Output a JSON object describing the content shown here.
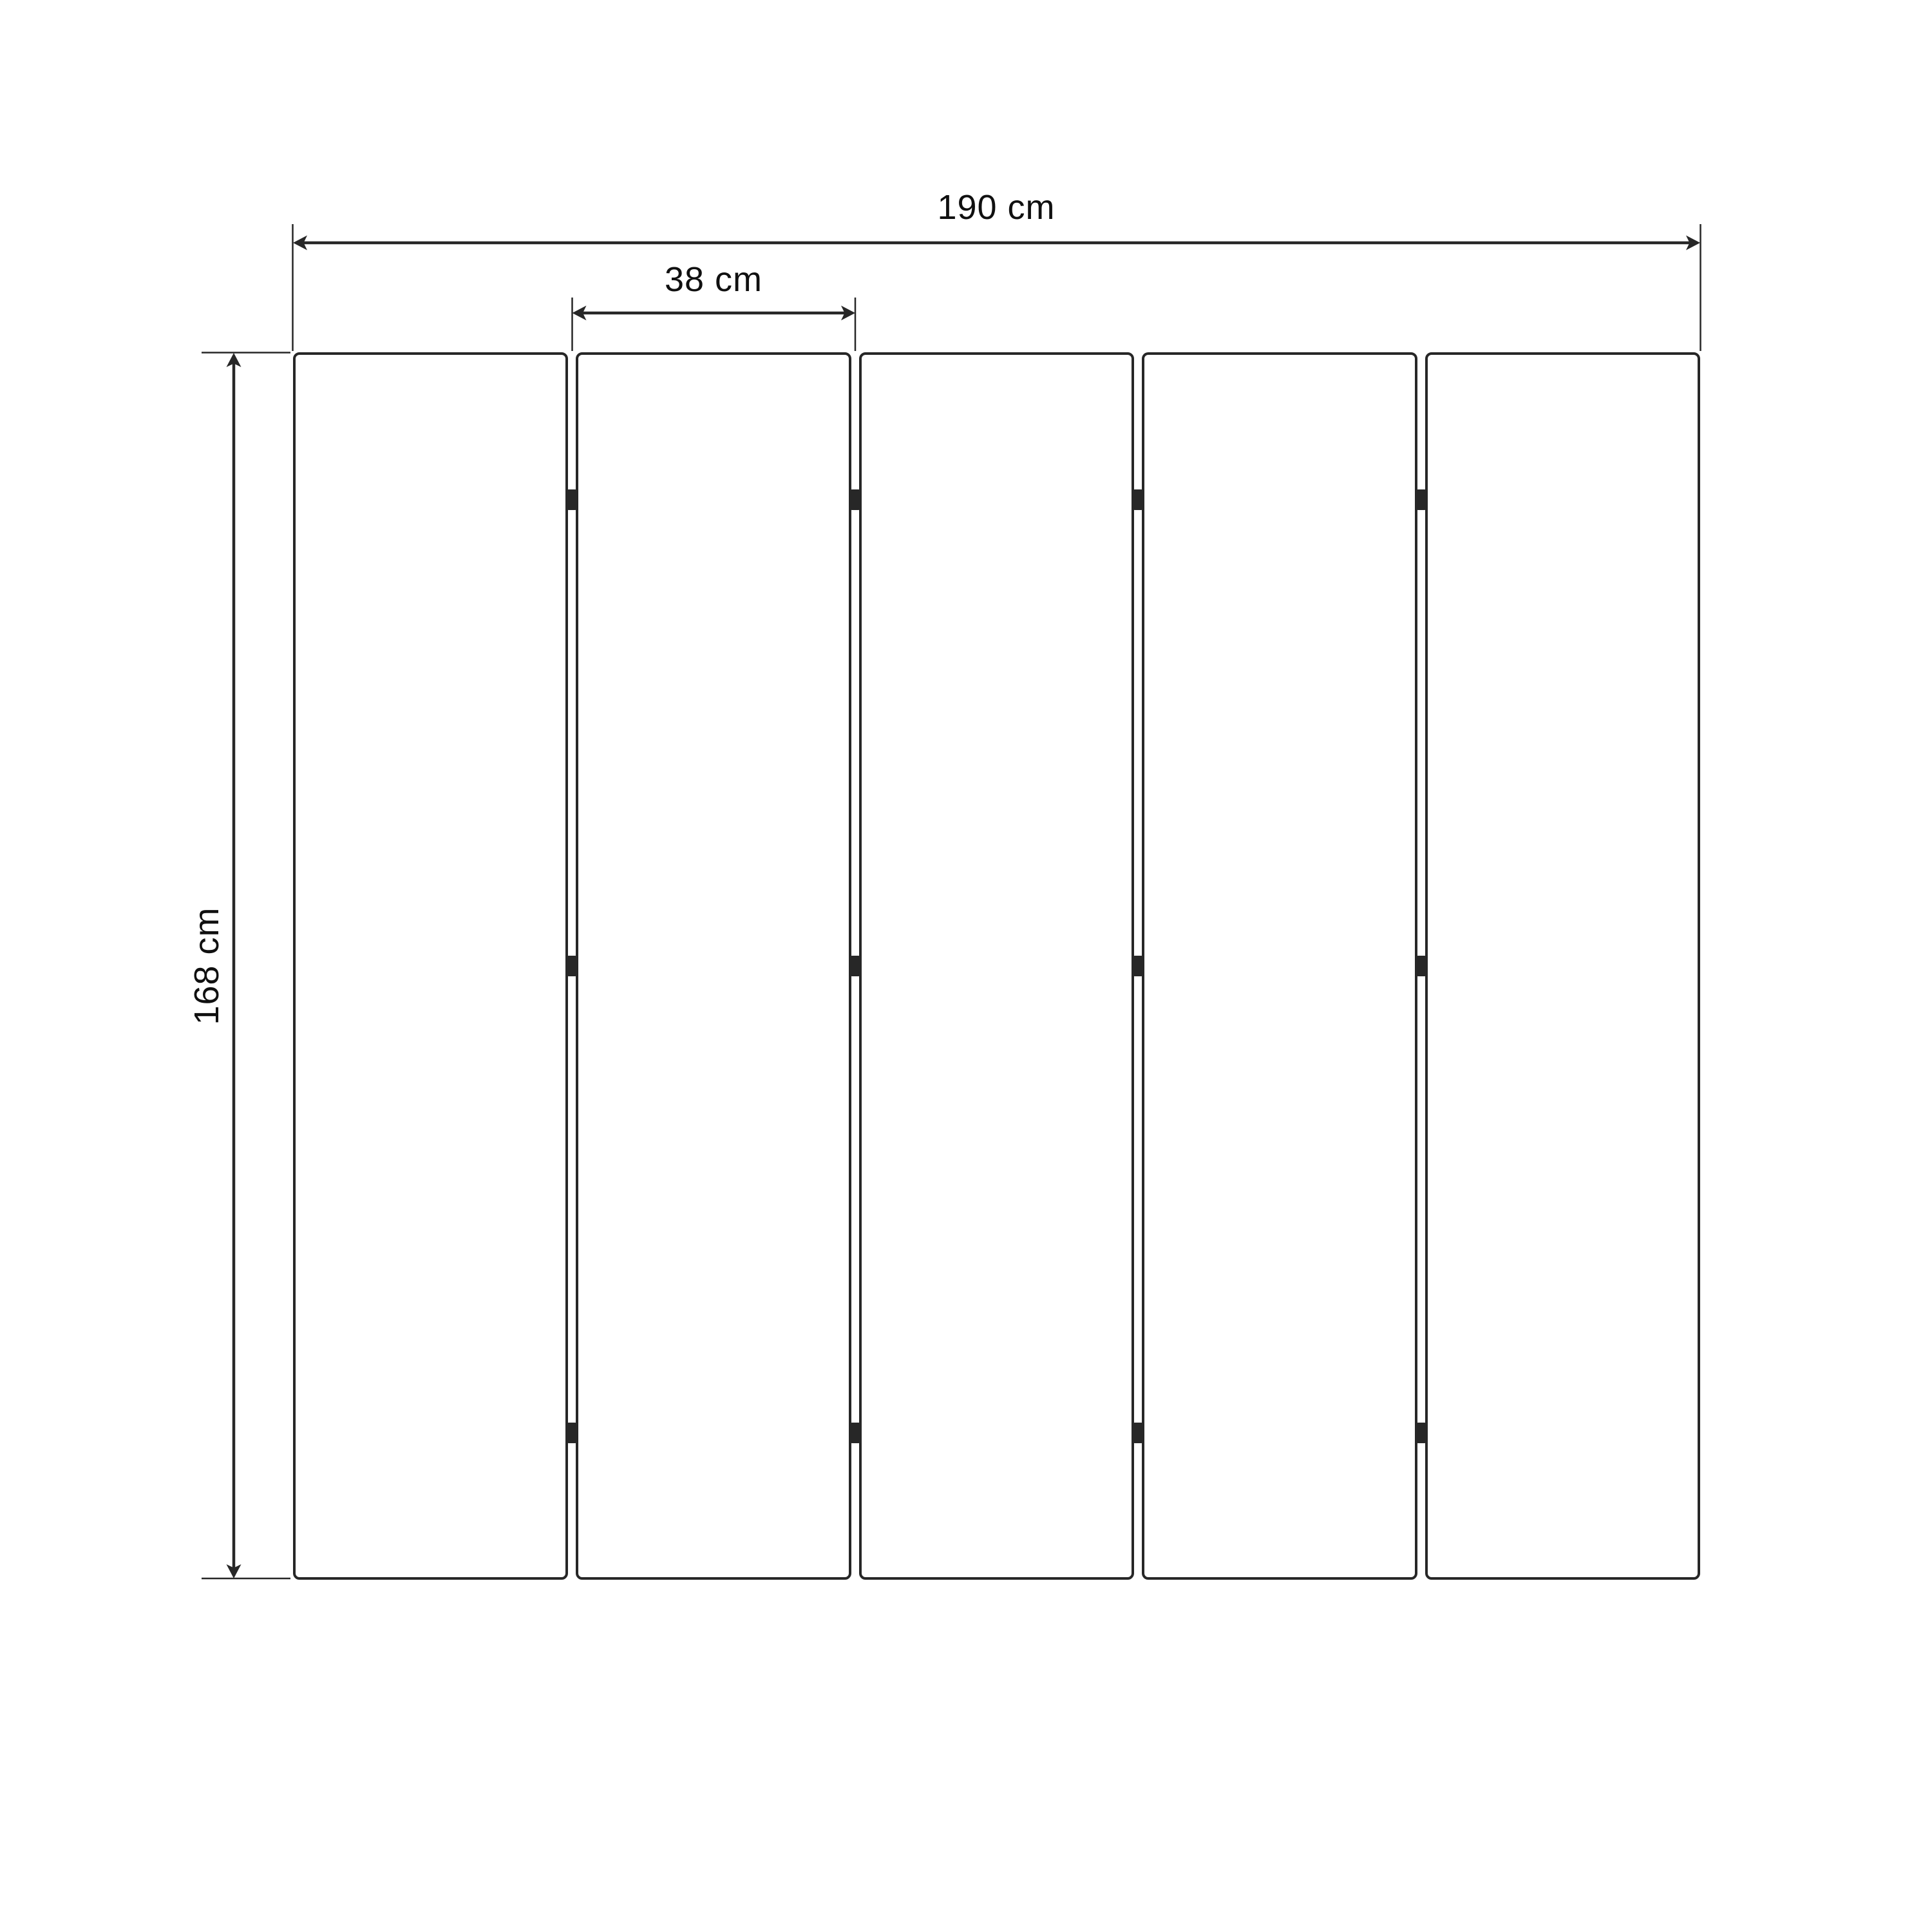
{
  "figure": {
    "type": "technical-dimension-diagram",
    "background_color": "#ffffff",
    "line_color": "#272727",
    "text_color": "#101010",
    "panel_count": 5,
    "hinge_rows": 3,
    "dimensions": {
      "total_width": "190 cm",
      "panel_width": "38 cm",
      "height": "168 cm"
    }
  }
}
